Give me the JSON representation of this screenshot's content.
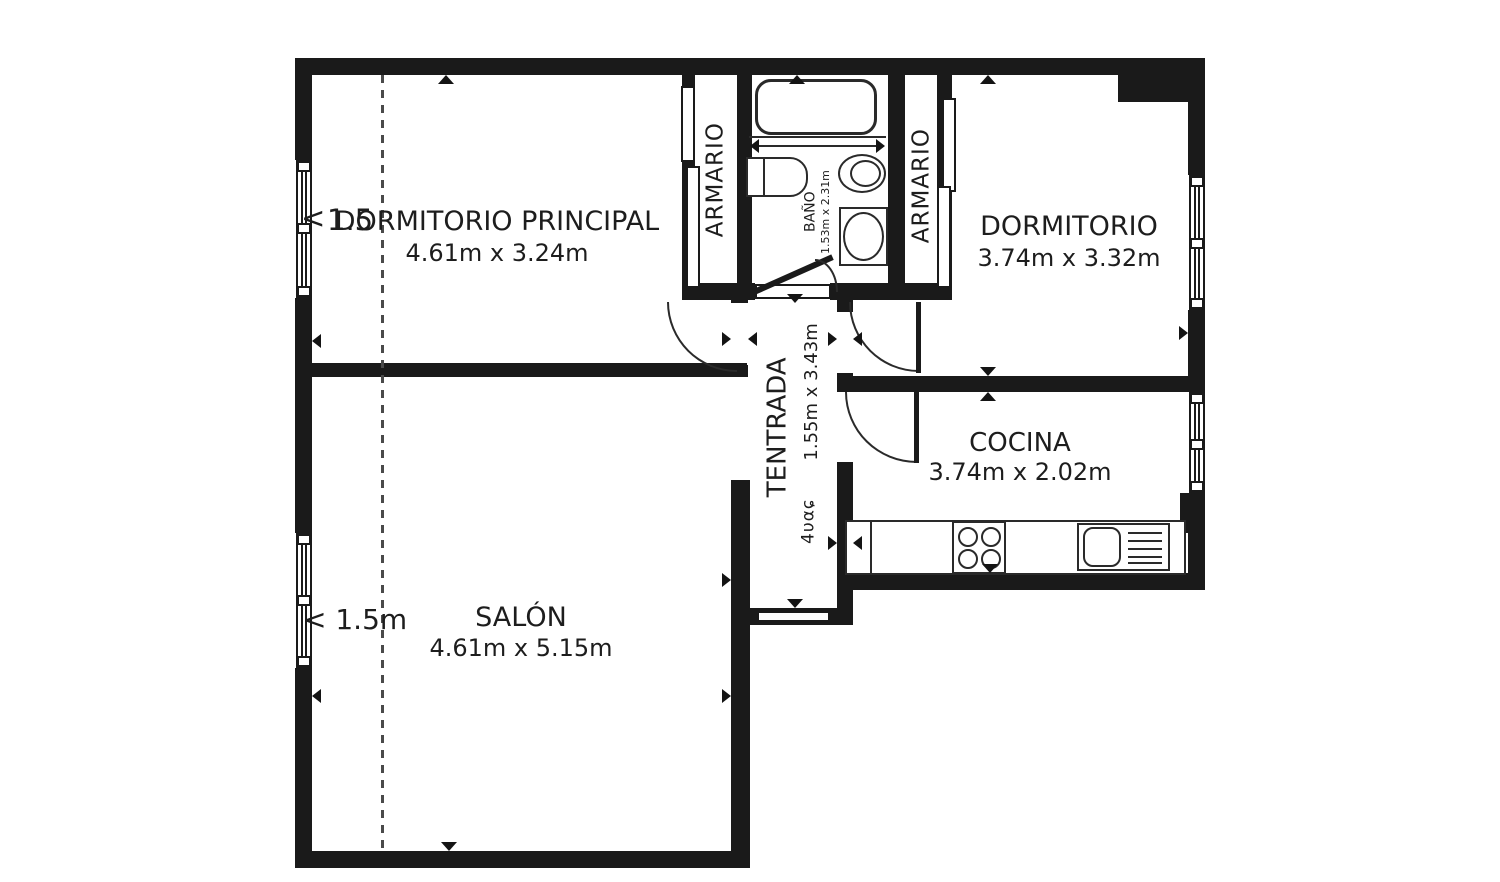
{
  "rooms": {
    "dormitorio_principal": {
      "name": "DORMITORIO PRINCIPAL",
      "dimensions": "4.61m x 3.24m"
    },
    "dormitorio": {
      "name": "DORMITORIO",
      "dimensions": "3.74m x 3.32m"
    },
    "cocina": {
      "name": "COCINA",
      "dimensions": "3.74m x 2.02m"
    },
    "salon": {
      "name": "SALÓN",
      "dimensions": "4.61m x 5.15m"
    },
    "entrada": {
      "name": "TENTRADA",
      "dimensions": "1.55m x 3.43m",
      "garbled_text": "4υαɕ"
    },
    "bano": {
      "name": "BAÑO",
      "dimensions": "1.53m x 2.31m"
    },
    "armario_left": {
      "name": "ARMARIO"
    },
    "armario_right": {
      "name": "ARMARIO"
    }
  },
  "annotations": {
    "salon_window_width": "< 1.5m",
    "dp_window_marker": "<",
    "dp_window_width": "1.5"
  },
  "colors": {
    "wall": "#1a1a1a",
    "background": "#ffffff",
    "text": "#1d1d1d"
  }
}
